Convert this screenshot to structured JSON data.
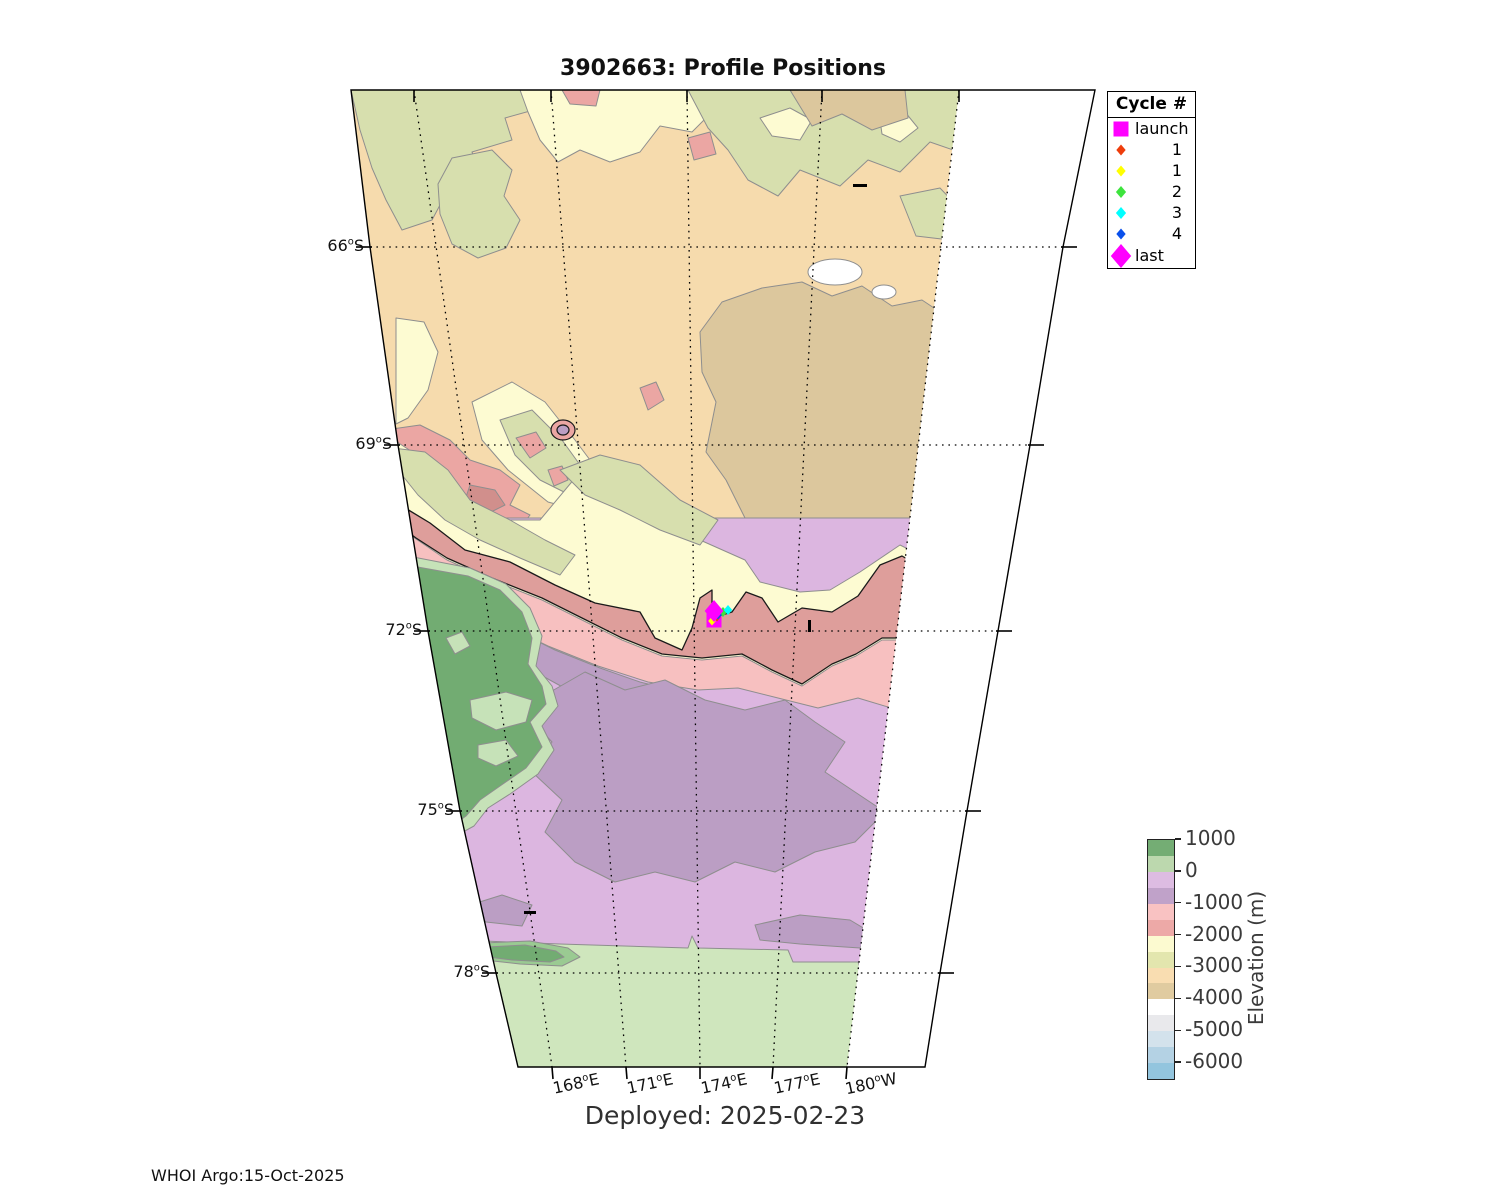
{
  "title": "3902663: Profile Positions",
  "deployed_text": "Deployed: 2025-02-23",
  "credit_text": "WHOI Argo:15-Oct-2025",
  "legend": {
    "title": "Cycle #",
    "items": [
      {
        "label": "launch",
        "marker": "square",
        "color": "#FF00FF",
        "size": 15,
        "align": "txt"
      },
      {
        "label": "1",
        "marker": "diamond",
        "color": "#EE3D0C",
        "size": 11,
        "align": "num"
      },
      {
        "label": "1",
        "marker": "diamond",
        "color": "#FFFF00",
        "size": 11,
        "align": "num"
      },
      {
        "label": "2",
        "marker": "diamond",
        "color": "#3DE43D",
        "size": 12,
        "align": "num"
      },
      {
        "label": "3",
        "marker": "diamond",
        "color": "#00FFFF",
        "size": 12,
        "align": "num"
      },
      {
        "label": "4",
        "marker": "diamond",
        "color": "#0A50EB",
        "size": 11,
        "align": "num"
      },
      {
        "label": "last",
        "marker": "diamond",
        "color": "#FF00FF",
        "size": 24,
        "align": "txt"
      }
    ]
  },
  "axes": {
    "lat_ticks": [
      {
        "label": "66°S",
        "y": 247,
        "x": 370
      },
      {
        "label": "69°S",
        "y": 445,
        "x": 398
      },
      {
        "label": "72°S",
        "y": 631,
        "x": 428
      },
      {
        "label": "75°S",
        "y": 811,
        "x": 460
      },
      {
        "label": "78°S",
        "y": 973,
        "x": 496
      }
    ],
    "lon_ticks": [
      {
        "label": "168°E",
        "x": 552
      },
      {
        "label": "171°E",
        "x": 626
      },
      {
        "label": "174°E",
        "x": 700
      },
      {
        "label": "177°E",
        "x": 773
      },
      {
        "label": "180°W",
        "x": 847
      }
    ]
  },
  "colorbar": {
    "label": "Elevation (m)",
    "tick_labels": [
      "1000",
      "0",
      "-1000",
      "-2000",
      "-3000",
      "-4000",
      "-5000",
      "-6000"
    ],
    "tick_values": [
      1000,
      0,
      -1000,
      -2000,
      -3000,
      -4000,
      -5000,
      -6000
    ],
    "range_top": 1000,
    "range_bottom": -6500,
    "segment_step": 500,
    "segment_colors": [
      "#74AD74",
      "#BCD8AE",
      "#DDBCE2",
      "#C0A2C9",
      "#F9C2C2",
      "#EDA9A7",
      "#FCFAD0",
      "#E3E6AE",
      "#F9DDB1",
      "#E0CBA0",
      "#FFFFFF",
      "#E9E9EC",
      "#D3E2EC",
      "#B4D2E4",
      "#93C5DE"
    ]
  },
  "markers": [
    {
      "name": "launch",
      "shape": "square",
      "color": "#FF00FF",
      "x": 714,
      "y": 620,
      "size": 15
    },
    {
      "name": "cycle-1",
      "shape": "diamond",
      "color": "#EE3D0C",
      "x": 717,
      "y": 617,
      "size": 9
    },
    {
      "name": "cycle-1b",
      "shape": "diamond",
      "color": "#FFFF00",
      "x": 712,
      "y": 621,
      "size": 9
    },
    {
      "name": "cycle-2",
      "shape": "diamond",
      "color": "#3DE43D",
      "x": 723,
      "y": 612,
      "size": 10
    },
    {
      "name": "cycle-3",
      "shape": "diamond",
      "color": "#00FFFF",
      "x": 728,
      "y": 610,
      "size": 10
    },
    {
      "name": "cycle-4",
      "shape": "diamond",
      "color": "#0A50EB",
      "x": 718,
      "y": 615,
      "size": 9
    },
    {
      "name": "last",
      "shape": "diamond",
      "color": "#FF00FF",
      "x": 714,
      "y": 611,
      "size": 22
    }
  ],
  "chart_data": {
    "type": "map-contour",
    "title": "3902663: Profile Positions",
    "float_id": "3902663",
    "deployed_date": "2025-02-23",
    "generated_by": "WHOI Argo",
    "generated_date": "15-Oct-2025",
    "region": "Ross Sea / Victoria Land, Antarctica",
    "lat_tick_labels": [
      "66°S",
      "69°S",
      "72°S",
      "75°S",
      "78°S"
    ],
    "lon_tick_labels": [
      "168°E",
      "171°E",
      "174°E",
      "177°E",
      "180°W"
    ],
    "legend_title": "Cycle #",
    "legend_entries": [
      "launch",
      "1",
      "1",
      "2",
      "3",
      "4",
      "last"
    ],
    "profile_positions": [
      {
        "cycle": "launch",
        "lat": -71.9,
        "lon": 174.6
      },
      {
        "cycle": "1",
        "lat": -71.9,
        "lon": 174.7
      },
      {
        "cycle": "1",
        "lat": -71.9,
        "lon": 174.6
      },
      {
        "cycle": "2",
        "lat": -71.8,
        "lon": 174.9
      },
      {
        "cycle": "3",
        "lat": -71.7,
        "lon": 175.0
      },
      {
        "cycle": "4",
        "lat": -71.8,
        "lon": 174.8
      },
      {
        "cycle": "last",
        "lat": -71.8,
        "lon": 174.6
      }
    ],
    "colorbar_label": "Elevation (m)",
    "colorbar_ticks_m": [
      1000,
      0,
      -1000,
      -2000,
      -3000,
      -4000,
      -5000,
      -6000
    ],
    "terrain_colors": {
      "land_high_green": "#72AC72",
      "land_low_green": "#C6E2B8",
      "ice_shelf_green": "#CFE6BD",
      "shelf_violet_light": "#DCB6E0",
      "shelf_violet_dark": "#BB9EC4",
      "slope_pink_light": "#F7C0C0",
      "slope_salmon": "#DE9E9B",
      "slope_pale_yellow": "#FDFBD2",
      "khaki": "#D7DFAE",
      "deep_orange": "#F6DBAD",
      "deep_tan": "#DCC79D",
      "abyss_white": "#FFFFFF",
      "contour_line": "#8E8E8E"
    }
  }
}
